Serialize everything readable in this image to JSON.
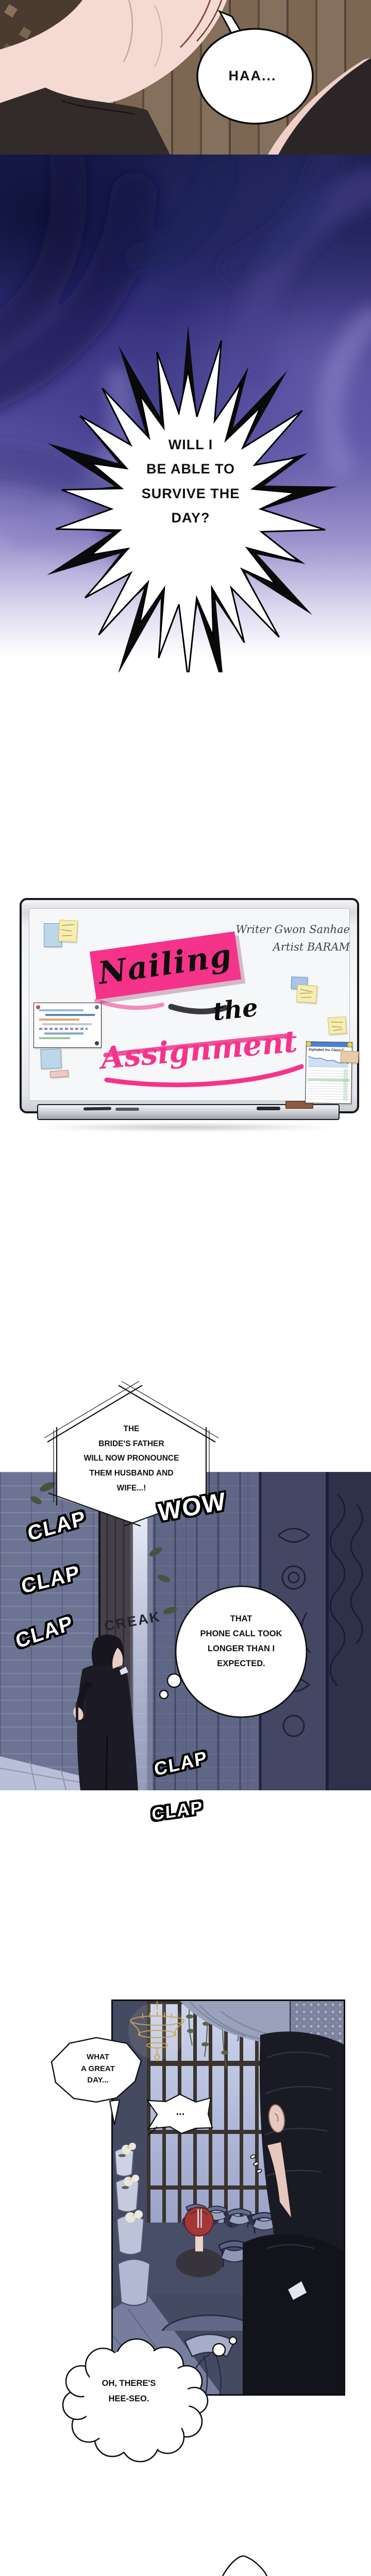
{
  "panel1": {
    "sfx_sigh": "HAA..."
  },
  "panel2": {
    "burst_text": "WILL I\nBE ABLE TO\nSURVIVE THE\nDAY?"
  },
  "board": {
    "credit_writer": "Writer Gwon Sanhae",
    "credit_artist": "Artist BARAM",
    "title_line1": "Nailing",
    "title_line2": "the",
    "title_line3": "Assignment",
    "stock_title": "Alphabet Inc Class C"
  },
  "panel4": {
    "announcement": "THE\nBRIDE'S FATHER\nWILL NOW PRONOUNCE\nTHEM HUSBAND AND\nWIFE...!",
    "sfx_wow": "WOW",
    "sfx_clap": "CLAP",
    "sfx_creak": "CREAK",
    "thought": "THAT\nPHONE CALL TOOK\nLONGER THAN I\nEXPECTED."
  },
  "panel5": {
    "speech_day": "WHAT\nA GREAT\nDAY...",
    "speech_dots": "...",
    "thought_heeseo": "OH, THERE'S\nHEE-SEO."
  },
  "colors": {
    "accent_pink": "#f5338a",
    "night_navy": "#1d2150",
    "violet": "#7a6fbc",
    "stone_wall": "#6d7392",
    "chandelier_gold": "#c9a753",
    "hair_red": "#a43736"
  }
}
